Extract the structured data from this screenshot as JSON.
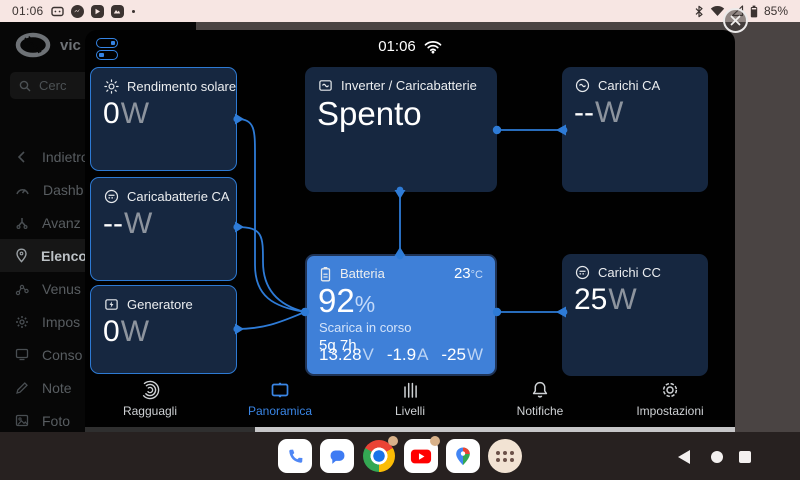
{
  "status_bar": {
    "time": "01:06",
    "battery_percent": "85%",
    "notification_icons": [
      "message-icon",
      "messenger-icon",
      "youtube-icon",
      "photos-icon",
      "overflow-dot"
    ],
    "system_icons": [
      "bluetooth-icon",
      "wifi-icon",
      "cellular-icon",
      "battery-icon"
    ]
  },
  "victron_app": {
    "logo_text": "vic",
    "search_placeholder": "Cerc",
    "menu": [
      {
        "label": "Indietro"
      },
      {
        "label": "Dashb"
      },
      {
        "label": "Avanz"
      },
      {
        "label": "Elenco",
        "selected": true
      },
      {
        "label": "Venus"
      },
      {
        "label": "Impos"
      },
      {
        "label": "Conso"
      },
      {
        "label": "Note"
      },
      {
        "label": "Foto"
      }
    ]
  },
  "remote_console": {
    "time": "01:06",
    "tiles": {
      "solar": {
        "label": "Rendimento solare",
        "value": "0",
        "unit": "W"
      },
      "ac_charger": {
        "label": "Caricabatterie CA",
        "value": "--",
        "unit": "W"
      },
      "generator": {
        "label": "Generatore",
        "value": "0",
        "unit": "W"
      },
      "inverter": {
        "label": "Inverter / Caricabatterie",
        "status": "Spento"
      },
      "battery": {
        "label": "Batteria",
        "temperature": "23",
        "temperature_unit": "°C",
        "soc": "92",
        "soc_unit": "%",
        "state": "Scarica in corso",
        "time_remaining": "5g 7h",
        "voltage": "13.28",
        "voltage_unit": "V",
        "current": "-1.9",
        "current_unit": "A",
        "power": "-25",
        "power_unit": "W"
      },
      "ac_loads": {
        "label": "Carichi CA",
        "value": "--",
        "unit": "W"
      },
      "dc_loads": {
        "label": "Carichi CC",
        "value": "25",
        "unit": "W"
      }
    },
    "tabs": [
      {
        "label": "Ragguagli"
      },
      {
        "label": "Panoramica",
        "active": true
      },
      {
        "label": "Livelli"
      },
      {
        "label": "Notifiche"
      },
      {
        "label": "Impostazioni"
      }
    ]
  },
  "dock": {
    "apps": [
      "phone",
      "messages",
      "chrome",
      "youtube",
      "maps",
      "app-drawer"
    ]
  },
  "colors": {
    "accent_blue": "#2e7bd6",
    "battery_tile": "#3f80d8",
    "tile_background": "#162740",
    "status_bar_background": "#f7e6e3",
    "active_tab": "#3a86e6"
  }
}
